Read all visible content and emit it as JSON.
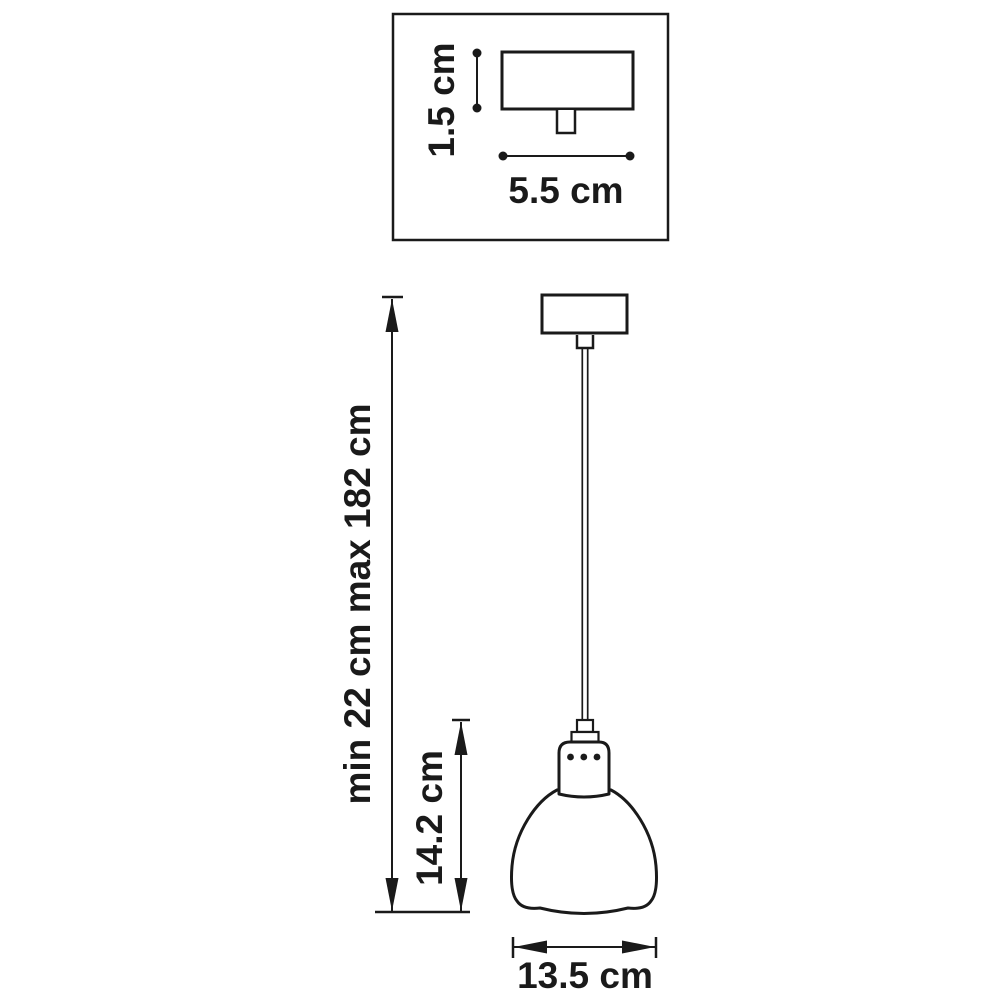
{
  "diagram": {
    "type": "pendant_lamp_dimension_drawing",
    "line_color": "#1a1a1a",
    "background": "#ffffff"
  },
  "inset": {
    "canopy_height": "1.5 cm",
    "canopy_width": "5.5 cm"
  },
  "dimensions": {
    "suspension_height": "min 22 cm max 182 cm",
    "shade_height": "14.2 cm",
    "shade_diameter": "13.5 cm"
  }
}
